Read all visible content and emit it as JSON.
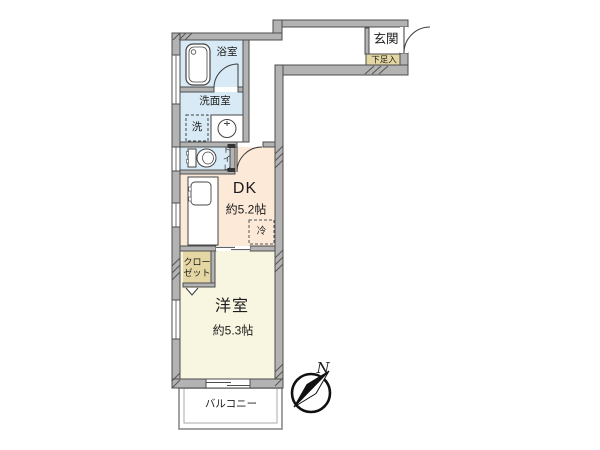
{
  "plan": {
    "rooms": {
      "bath": {
        "label": "浴室"
      },
      "washroom": {
        "label": "洗面室"
      },
      "washer": {
        "label": "洗"
      },
      "toilet": {
        "label": "トイレ"
      },
      "dk": {
        "label": "DK",
        "size": "約5.2帖"
      },
      "fridge": {
        "label": "冷"
      },
      "closet": {
        "label_line1": "クロー",
        "label_line2": "ゼット"
      },
      "western_room": {
        "label": "洋室",
        "size": "約5.3帖"
      },
      "balcony": {
        "label": "バルコニー"
      },
      "entrance": {
        "label": "玄関"
      },
      "shoe_box": {
        "label": "下足入"
      }
    },
    "compass": {
      "north_label": "N"
    },
    "colors": {
      "wet_room": "#d8eaf5",
      "dk": "#fce9d8",
      "western": "#f8f5e1",
      "storage": "#e4d7a4",
      "wall": "#b3b3b3",
      "wall_line": "#4d4d4d"
    }
  }
}
